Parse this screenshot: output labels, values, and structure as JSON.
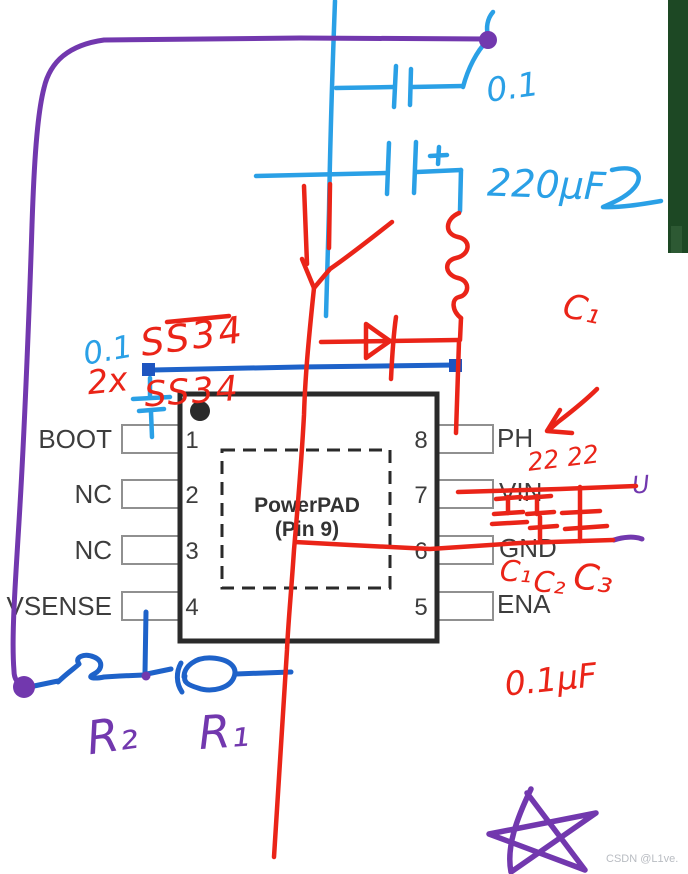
{
  "figure": {
    "chip": {
      "powerpad_line1": "PowerPAD",
      "powerpad_line2": "(Pin 9)",
      "left_pins": [
        {
          "number": "1",
          "label": "BOOT"
        },
        {
          "number": "2",
          "label": "NC"
        },
        {
          "number": "3",
          "label": "NC"
        },
        {
          "number": "4",
          "label": "VSENSE"
        }
      ],
      "right_pins": [
        {
          "number": "8",
          "label": "PH"
        },
        {
          "number": "7",
          "label": "VIN"
        },
        {
          "number": "6",
          "label": "GND"
        },
        {
          "number": "5",
          "label": "ENA"
        }
      ]
    }
  },
  "annotations": {
    "red": {
      "diode_part_top": "SS34",
      "quantity": "2x",
      "diode_part_bottom": "SS34",
      "cap_label_top": "C₁",
      "ph_note": "22 22",
      "cap_label_gnd_1": "C₁",
      "cap_label_gnd_2": "C₂",
      "cap_label_gnd_3": "C₃",
      "cap_value_bottom": "0.1µF"
    },
    "blue": {
      "top_cap_value": "0.1",
      "output_cap_value": "220µF",
      "boot_cap_value": "0.1"
    },
    "purple": {
      "resistor_left": "R₂",
      "resistor_right": "R₁",
      "vin_mark": "U"
    }
  },
  "watermark": "CSDN @L1ve.",
  "colors": {
    "red_ink": "#ea2418",
    "cyan_ink": "#2aa0e6",
    "blue_ink": "#1e62c9",
    "purple_ink": "#7238ae",
    "green_strip": "#1d4824",
    "chip_outline": "#2a2a2a",
    "pin_box_border": "#909090",
    "label_text": "#3d3d3d",
    "watermark_text": "#b9bcc2"
  }
}
